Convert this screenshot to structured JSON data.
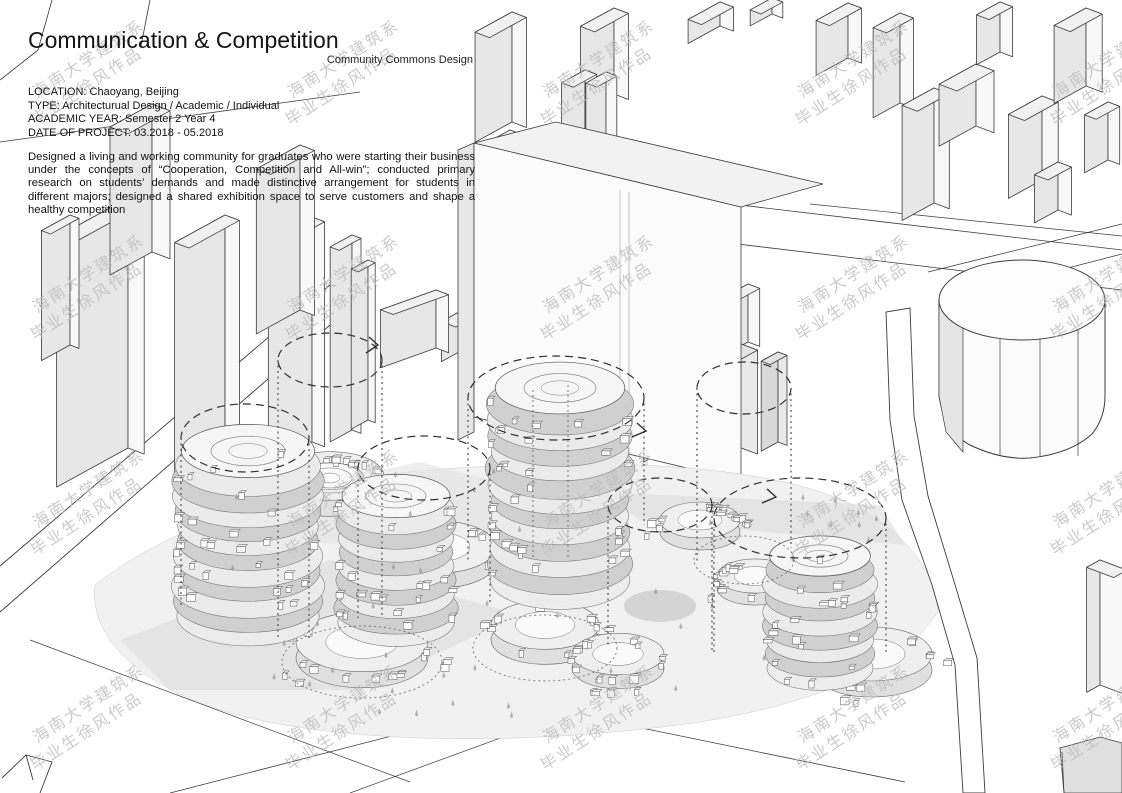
{
  "header": {
    "title": "Communication & Competition",
    "subtitle": "Community Commons Design",
    "info_lines": [
      "LOCATION: Chaoyang, Beijing",
      "TYPE: Architecturual Design / Academic / Individual",
      "ACADEMIC YEAR: Semester 2 Year 4",
      "DATE OF PROJECT: 03.2018 - 05.2018"
    ],
    "description": "Designed a living and working community for graduates who were starting their business under the concepts of “Cooperation, Competition and All-win”; conducted primary research on students’ demands and made distinctive arrangement for students in different majors; designed a shared exhibition space to serve customers and shape a healthy competition"
  },
  "watermark": {
    "line1": "海南大学建筑系",
    "line2": "毕业生徐风作品"
  },
  "colors": {
    "line": "#3c3c3c",
    "building_shade": "#e7e7e7",
    "building_light": "#f8f8f8",
    "site_ground": "#f1f1f1",
    "annotation_dash": "#2f2f2f",
    "watermark_gray": "#bcbcbc"
  }
}
